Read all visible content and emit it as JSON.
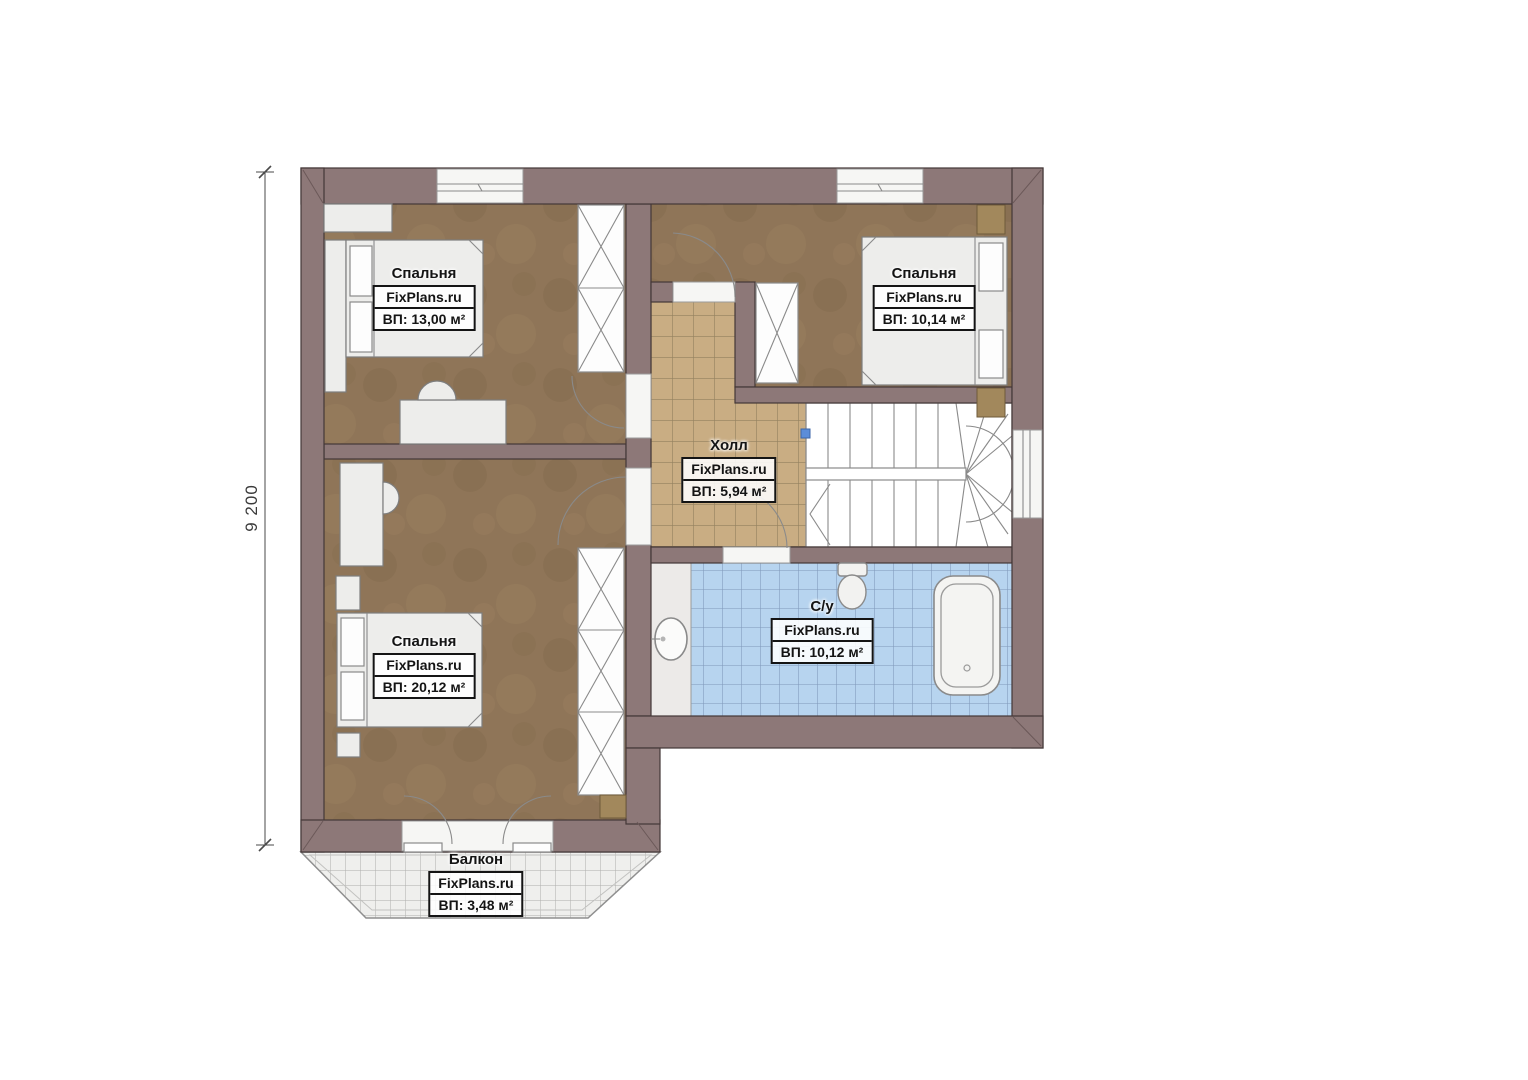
{
  "dimension": {
    "value": "9 200"
  },
  "rooms": [
    {
      "id": "bedroom-top-left",
      "name": "Спальня",
      "watermark": "FixPlans.ru",
      "area": "ВП: 13,00 м²"
    },
    {
      "id": "bedroom-top-right",
      "name": "Спальня",
      "watermark": "FixPlans.ru",
      "area": "ВП: 10,14 м²"
    },
    {
      "id": "hall",
      "name": "Холл",
      "watermark": "FixPlans.ru",
      "area": "ВП: 5,94 м²"
    },
    {
      "id": "bathroom",
      "name": "С/у",
      "watermark": "FixPlans.ru",
      "area": "ВП: 10,12 м²"
    },
    {
      "id": "bedroom-bottom-left",
      "name": "Спальня",
      "watermark": "FixPlans.ru",
      "area": "ВП: 20,12 м²"
    },
    {
      "id": "balcony",
      "name": "Балкон",
      "watermark": "FixPlans.ru",
      "area": "ВП: 3,48 м²"
    }
  ],
  "colors": {
    "wall": "#8d7878",
    "floor": "#8f7558",
    "hall_tile": "#c9ad83",
    "bath_tile": "#b7d4ef",
    "balcony": "#efefed",
    "furniture": "#ededeb",
    "wood": "#a2885c",
    "marker": "#5b8dd9"
  }
}
